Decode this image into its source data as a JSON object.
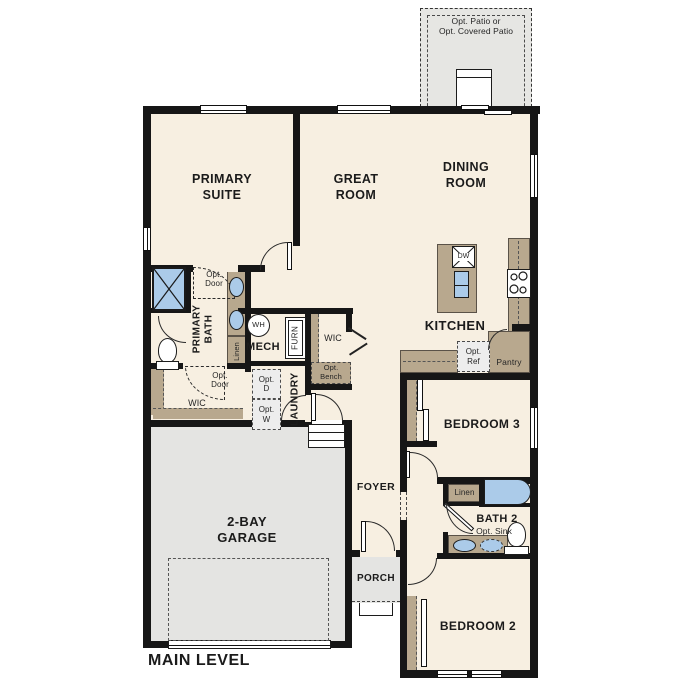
{
  "plan": {
    "level_label": "MAIN LEVEL",
    "rooms": {
      "primary_suite": "PRIMARY\nSUITE",
      "great_room": "GREAT\nROOM",
      "dining_room": "DINING\nROOM",
      "kitchen": "KITCHEN",
      "pantry": "Pantry",
      "mech": "MECH",
      "laundry": "LAUNDRY",
      "primary_bath": "PRIMARY\nBATH",
      "wic": "WIC",
      "foyer": "FOYER",
      "porch": "PORCH",
      "garage": "2-BAY\nGARAGE",
      "bedroom3": "BEDROOM 3",
      "bath2": "BATH 2",
      "bedroom2": "BEDROOM 2"
    },
    "features": {
      "opt_patio": "Opt. Patio or\nOpt. Covered Patio",
      "opt_door": "Opt.\nDoor",
      "opt_bench": "Opt.\nBench",
      "opt_ref": "Opt.\nRef",
      "opt_dryer": "Opt.\nD",
      "opt_washer": "Opt.\nW",
      "opt_sink": "Opt. Sink",
      "linen": "Linen",
      "water_heater": "WH",
      "furnace": "FURN",
      "dishwasher": "DW"
    },
    "colors": {
      "floor": "#f7efe1",
      "wall": "#161616",
      "counter": "#b8a88e",
      "blue": "#abcbe9",
      "garage": "#e4e4e2",
      "patio": "#e6e6e3",
      "opt": "#ededed"
    }
  }
}
